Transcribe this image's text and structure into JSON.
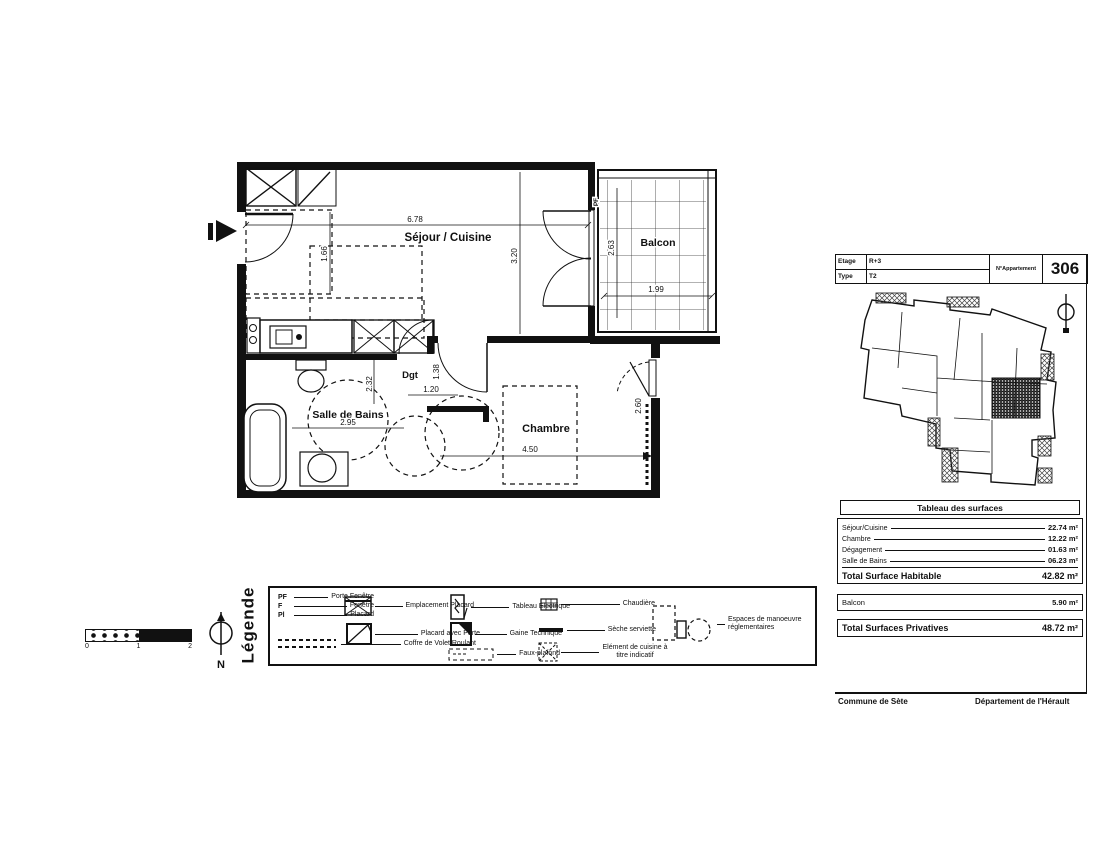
{
  "plan": {
    "labels": {
      "sejour_cuisine": "Séjour / Cuisine",
      "balcon": "Balcon",
      "salle_de_bains": "Salle de Bains",
      "chambre": "Chambre",
      "degagement_abbr": "Dgt",
      "porte_fenetre_abbr": "PF"
    },
    "dimensions": {
      "sejour_width": "6.78",
      "sejour_depth": "3.20",
      "kitchen_depth": "1.66",
      "balcon_width": "1.99",
      "balcon_depth": "2.63",
      "bath_width": "2.95",
      "bath_depth": "2.32",
      "dgt_width": "1.20",
      "dgt_depth": "1.38",
      "chambre_width": "4.50",
      "chambre_depth": "2.60"
    }
  },
  "legend": {
    "title": "Légende",
    "abbreviations": [
      {
        "abbr": "PF",
        "label": "Porte Fenêtre"
      },
      {
        "abbr": "F",
        "label": "Fenêtre"
      },
      {
        "abbr": "Pl",
        "label": "Placard"
      }
    ],
    "items": {
      "emplacement_placard": "Emplacement Placard",
      "placard_avec_porte": "Placard avec Porte",
      "coffre_volet_roulant": "Coffre de Volet Roulant",
      "tableau_electrique": "Tableau Electrique",
      "gaine_technique": "Gaine Technique",
      "faux_plafond": "Faux-plafond",
      "chaudiere": "Chaudière",
      "seche_serviette": "Sèche serviette",
      "element_cuisine": "Elément de cuisine à titre indicatif",
      "espaces_manoeuvre": "Espaces de manoeuvre réglementaires"
    }
  },
  "scale_bar": {
    "ticks": [
      "0",
      "1",
      "2"
    ]
  },
  "north": {
    "label": "N"
  },
  "panel": {
    "header": {
      "etage_label": "Etage",
      "etage_value": "R+3",
      "type_label": "Type",
      "type_value": "T2",
      "apartment_label": "N°Appartement",
      "apartment_number": "306"
    },
    "surfaces": {
      "title": "Tableau des surfaces",
      "rows": [
        {
          "label": "Séjour/Cuisine",
          "value": "22.74 m²"
        },
        {
          "label": "Chambre",
          "value": "12.22 m²"
        },
        {
          "label": "Dégagement",
          "value": "01.63 m²"
        },
        {
          "label": "Salle de Bains",
          "value": "06.23 m²"
        }
      ],
      "total_habitable": {
        "label": "Total Surface Habitable",
        "value": "42.82 m²"
      },
      "balcon_row": {
        "label": "Balcon",
        "value": "5.90 m²"
      },
      "total_privatives": {
        "label": "Total Surfaces Privatives",
        "value": "48.72 m²"
      }
    },
    "footer": {
      "commune": "Commune de Sète",
      "departement": "Département de l'Hérault"
    }
  },
  "colors": {
    "ink": "#111111",
    "paper": "#ffffff"
  }
}
